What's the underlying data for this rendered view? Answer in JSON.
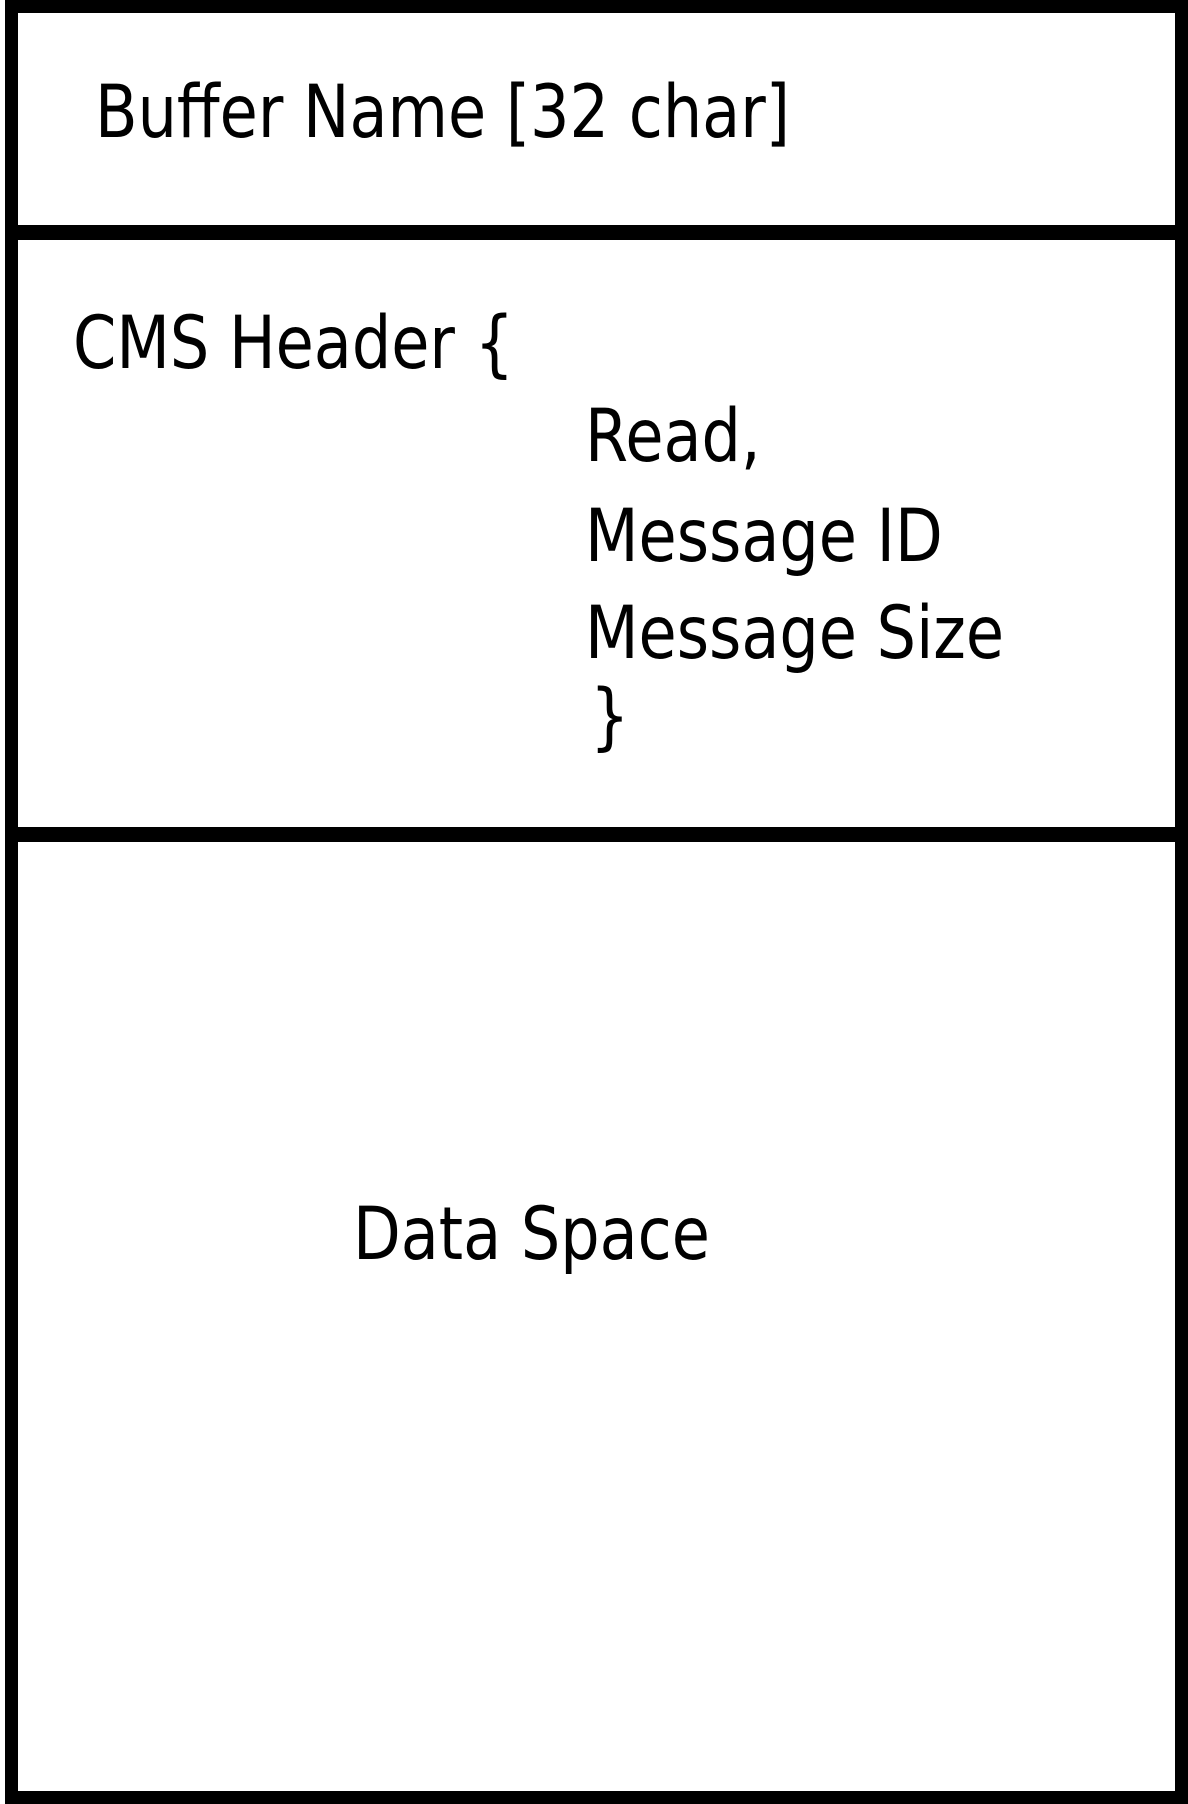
{
  "diagram": {
    "buffer_name_label": "Buffer Name [32 char]",
    "cms_header": {
      "open": "CMS Header {",
      "fields": [
        "Read,",
        "Message ID",
        "Message Size"
      ],
      "close": "}"
    },
    "data_space_label": "Data Space"
  },
  "colors": {
    "line": "#000000",
    "background": "#ffffff"
  }
}
